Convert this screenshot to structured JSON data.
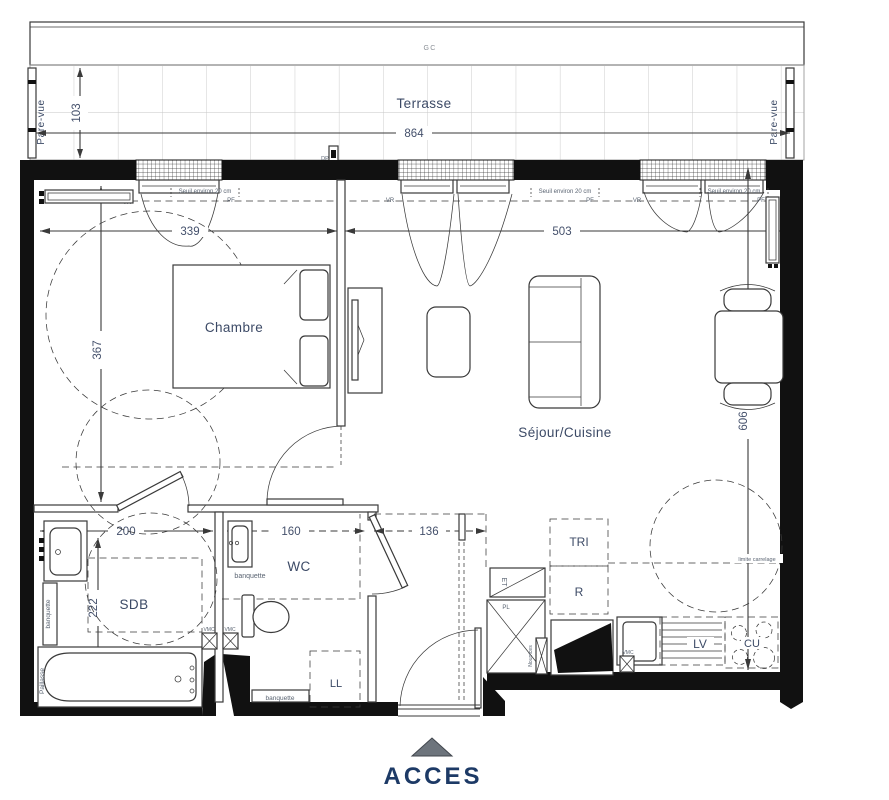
{
  "plan": {
    "access_label": "ACCES",
    "rooms": {
      "terrasse": "Terrasse",
      "chambre": "Chambre",
      "sejour_cuisine": "Séjour/Cuisine",
      "sdb": "SDB",
      "wc": "WC"
    },
    "dims": {
      "terrasse_w": "864",
      "terrasse_d": "103",
      "chambre_w": "339",
      "chambre_d": "367",
      "sejour_w": "503",
      "sejour_d": "606",
      "sdb_w": "200",
      "sdb_d": "222",
      "wc_w": "160",
      "entry_w": "136"
    },
    "annotations": {
      "gc": "GC",
      "pare_vue": "Pare-vue",
      "dp": "DP",
      "seuil": "Seuil environ 20 cm",
      "vr": "VR",
      "pf": "PF",
      "banquette": "banquette",
      "paillasse": "Paillasse",
      "vmc": "VMC",
      "ll": "LL",
      "tri": "TRI",
      "refrigerator": "R",
      "lave_vaisselle": "LV",
      "cuisson": "CU",
      "et": "ET",
      "placard": "PL",
      "nourrices": "Nourrices",
      "limite_carrelage": "limite carrelage"
    },
    "colors": {
      "wall": "#111111",
      "line": "#3a3a3a",
      "label": "#3c4a66",
      "dim": "#44506b",
      "tiny": "#5a6472",
      "access_text": "#1d3a66",
      "access_triangle": "#6d747c",
      "tile_line": "#c6c6c6"
    }
  }
}
